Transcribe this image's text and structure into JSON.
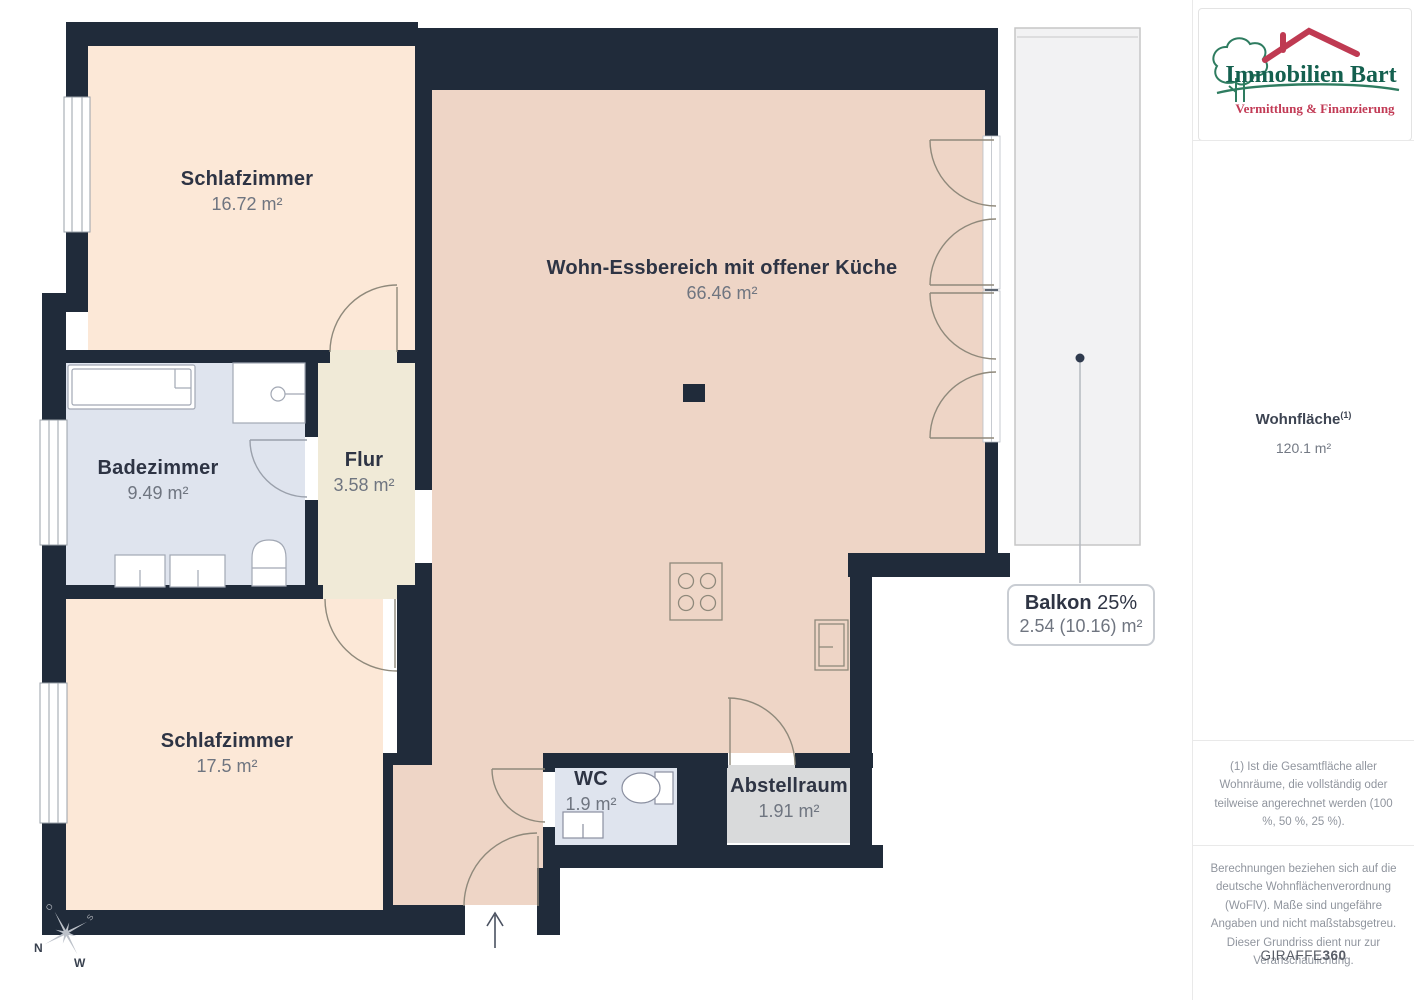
{
  "rooms": [
    {
      "id": "schlafzimmer-1",
      "name": "Schlafzimmer",
      "area": "16.72 m²"
    },
    {
      "id": "wohnbereich",
      "name": "Wohn-Essbereich mit offener Küche",
      "area": "66.46 m²"
    },
    {
      "id": "badezimmer",
      "name": "Badezimmer",
      "area": "9.49 m²"
    },
    {
      "id": "flur",
      "name": "Flur",
      "area": "3.58 m²"
    },
    {
      "id": "schlafzimmer-2",
      "name": "Schlafzimmer",
      "area": "17.5 m²"
    },
    {
      "id": "wc",
      "name": "WC",
      "area": "1.9 m²"
    },
    {
      "id": "abstellraum",
      "name": "Abstellraum",
      "area": "1.91 m²"
    }
  ],
  "balkon_label": {
    "name": "Balkon",
    "percent": "25%",
    "area": "2.54 (10.16) m²"
  },
  "compass": {
    "n": "N",
    "w": "W",
    "o": "O",
    "s": "S"
  },
  "sidebar": {
    "logo": {
      "title": "Immobilien Bart",
      "subtitle": "Vermittlung & Finanzierung"
    },
    "wohnflaeche": {
      "label": "Wohnfläche",
      "superscript": "(1)",
      "value": "120.1 m²"
    },
    "footnote": "(1) Ist die Gesamtfläche aller Wohnräume, die vollständig oder teilweise angerechnet werden (100 %, 50 %, 25 %).",
    "disclaimer": "Berechnungen beziehen sich auf die deutsche Wohnflächenverordnung (WoFlV). Maße sind ungefähre Angaben und nicht maßstabsgetreu. Dieser Grundriss dient nur zur Veranschaulichung.",
    "brand": {
      "part1": "GIRAFFE",
      "part2": "360"
    }
  },
  "colors": {
    "wall": "#202b3a",
    "bedroom_floor": "#fce8d7",
    "living_floor": "#eed5c6",
    "flur_floor": "#f0ead7",
    "bath_floor": "#dfe4ee",
    "storage_floor": "#d9dadb",
    "balcony_floor": "#f2f2f3",
    "logo_green": "#2e7c60",
    "logo_teal": "#14604f",
    "logo_red": "#bf3a52"
  }
}
